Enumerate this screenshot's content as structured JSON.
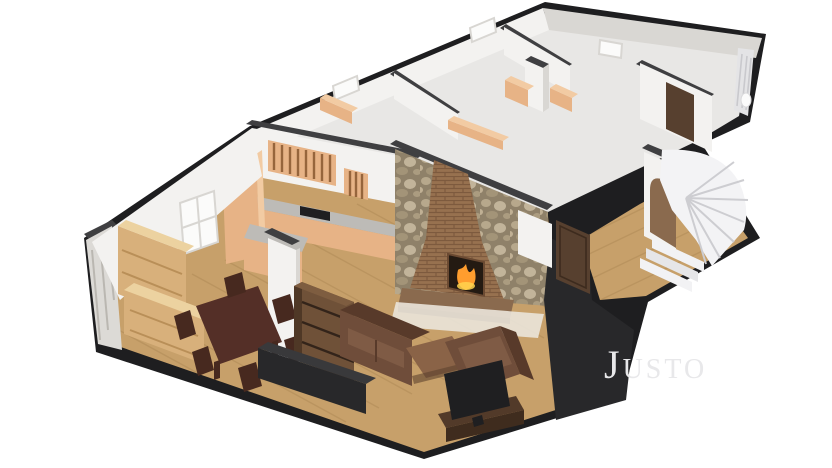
{
  "watermark": {
    "text": "Justo"
  },
  "colors": {
    "background": "#ffffff",
    "slab_dark": "#1e1e20",
    "wall_cut": "#3f3f41",
    "wall_white": "#f3f2f0",
    "wall_shade": "#d9d7d3",
    "floor_pale": "#e8e7e5",
    "floor_wood": "#c7a06a",
    "floor_wood_dark": "#a5814f",
    "cabinet_wood": "#e7b386",
    "pine_wood": "#d8b07b",
    "dark_table": "#542f27",
    "sofa_leather": "#6f4d3a",
    "stone_wall": "#8f8169",
    "brick": "#97714f",
    "fire": "#ff9d2e",
    "door_wood": "#57402f",
    "stairs": "#f3f3f5",
    "tv_black": "#1f1f21",
    "console_dark": "#28282a",
    "curtain": "#e4e4e6",
    "watermark": "#e8e8ea"
  },
  "scene": {
    "view": "isometric cutaway (dollhouse) 3D render of a single-storey home on a white background",
    "rooms": [
      {
        "name": "kitchen",
        "contents": [
          "slatted upper cabinets",
          "tall wooden cabinet",
          "countertop with dark cooktop",
          "base cabinets",
          "peninsula counter"
        ]
      },
      {
        "name": "dining-room",
        "contents": [
          "dark wood dining table",
          "six dark wood chairs",
          "pine hutch with shelves",
          "pine sideboard",
          "window in back wall"
        ]
      },
      {
        "name": "living-room",
        "contents": [
          "stone feature wall",
          "brick chimney fireplace with lit fire",
          "two brown leather sofas",
          "wooden coffee table",
          "flat TV on wooden stand",
          "dark media console",
          "wooden shelving unit"
        ]
      },
      {
        "name": "bedroom-left",
        "contents": [
          "wooden dresser"
        ]
      },
      {
        "name": "bedroom-middle",
        "contents": [
          "two wooden wardrobes",
          "white chimney stack"
        ]
      },
      {
        "name": "bedroom-front",
        "contents": [
          "long wooden sideboard"
        ]
      },
      {
        "name": "corner-room",
        "contents": [
          "dark wooden door",
          "curtains on outer wall"
        ]
      },
      {
        "name": "hallway",
        "contents": [
          "dark wooden entrance door",
          "wood plank floor"
        ]
      },
      {
        "name": "stairwell",
        "contents": [
          "white winder staircase",
          "arched under-stair wooden door"
        ]
      }
    ]
  }
}
